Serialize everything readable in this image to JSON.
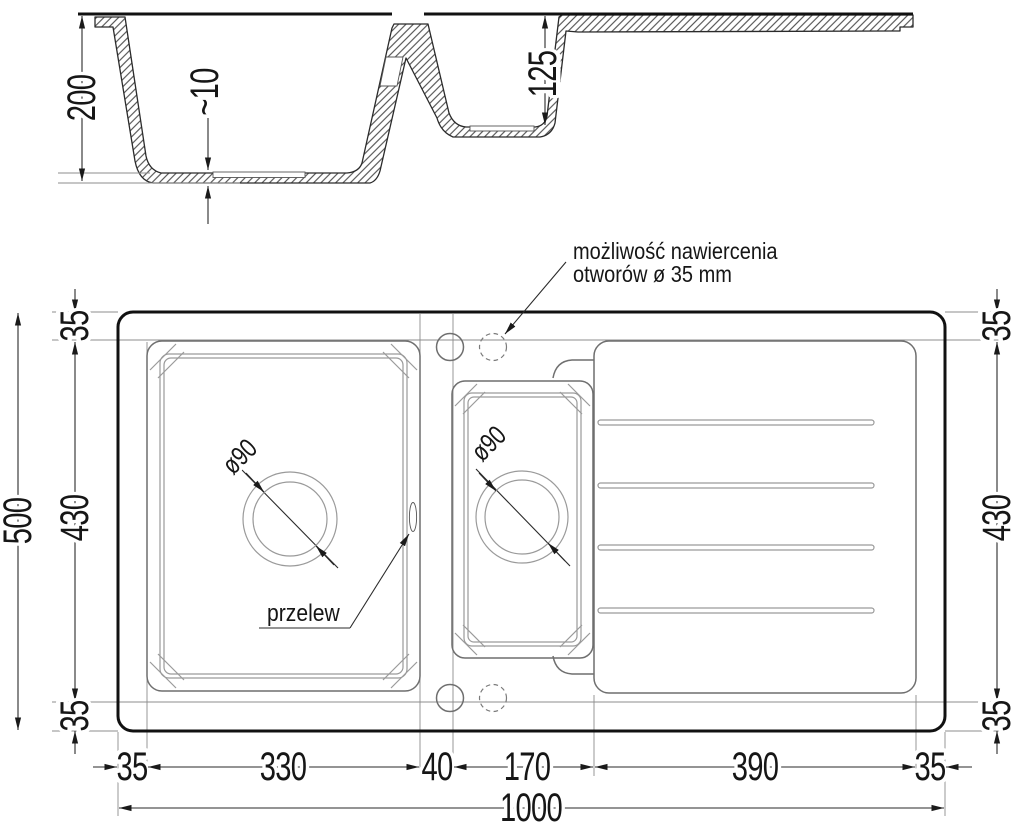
{
  "section": {
    "label_depth_main": "200",
    "label_floor_thickness": "~10",
    "label_depth_small": "125"
  },
  "plan": {
    "drill_note_line1": "możliwość nawiercenia",
    "drill_note_line2": "otworów ø 35 mm",
    "overflow_label": "przelew",
    "drain_main_label": "ø90",
    "drain_small_label": "ø90"
  },
  "dims": {
    "total_width": "1000",
    "total_depth": "500",
    "inner_depth_left": "430",
    "inner_depth_right": "430",
    "top_margin_left": "35",
    "bottom_margin_left": "35",
    "top_margin_right": "35",
    "bottom_margin_right": "35",
    "left_margin": "35",
    "main_bowl_width": "330",
    "divider_width": "40",
    "small_bowl_width": "170",
    "drainer_width": "390",
    "right_margin": "35"
  },
  "colors": {
    "line_heavy": "#111111",
    "line_medium": "#6f6f6f",
    "line_dim": "#2a2a2a",
    "hatch": "#3c3c3c",
    "background": "#ffffff"
  }
}
